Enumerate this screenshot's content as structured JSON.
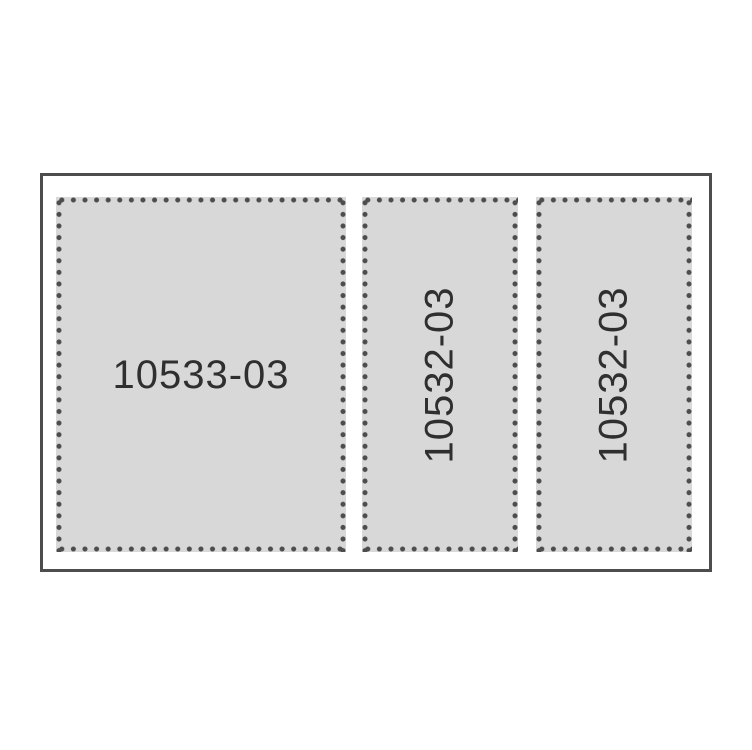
{
  "diagram": {
    "type": "parts-diagram",
    "panels": [
      {
        "part_number": "10533-03",
        "label_orientation": "horizontal",
        "border_style": "dotted",
        "size": "large"
      },
      {
        "part_number": "10532-03",
        "label_orientation": "vertical",
        "border_style": "dotted",
        "size": "narrow"
      },
      {
        "part_number": "10532-03",
        "label_orientation": "vertical",
        "border_style": "dotted",
        "size": "narrow"
      }
    ],
    "colors": {
      "background": "#ffffff",
      "frame_border": "#4d4d4d",
      "panel_fill": "#d8d8d8",
      "perforation_dot": "#4d4d4d",
      "label_text": "#2f2f2f"
    }
  }
}
